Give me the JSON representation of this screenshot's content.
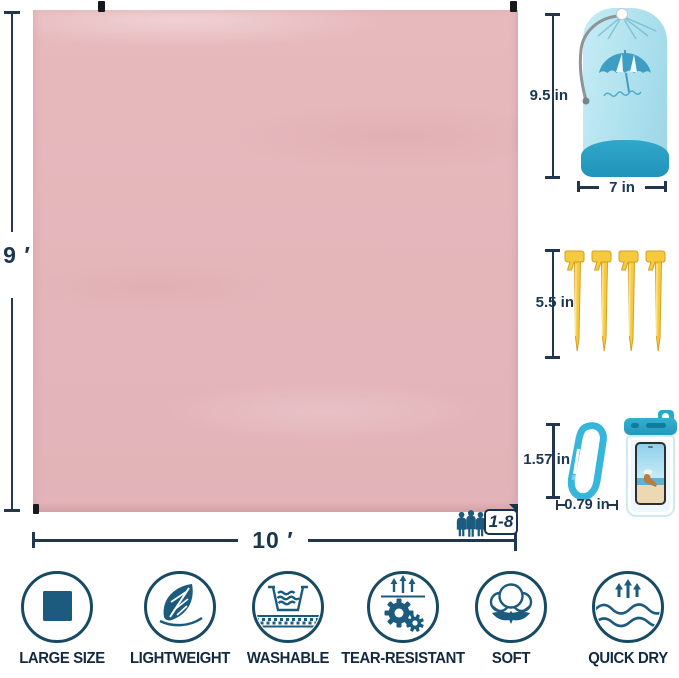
{
  "product": {
    "name": "beach-blanket-infographic",
    "blanket_color": "#e5b6bb",
    "accent_navy": "#16354d",
    "icon_blue": "#1d5b7e",
    "sack_blue": "#b9e6f0",
    "sack_band_blue": "#2aa5c9",
    "stake_yellow": "#f6ca3e",
    "carabiner_blue": "#36b6db"
  },
  "dims": {
    "blanket_height": "9 ′",
    "blanket_width": "10 ′",
    "sack_height": "9.5 in",
    "sack_width": "7 in",
    "stake_length": "5.5 in",
    "carabiner_height": "1.57 in",
    "carabiner_width": "0.79 in"
  },
  "capacity": {
    "label": "1-8"
  },
  "features": [
    {
      "label": "LARGE SIZE",
      "icon": "square-icon"
    },
    {
      "label": "LIGHTWEIGHT",
      "icon": "leaf-icon"
    },
    {
      "label": "WASHABLE",
      "icon": "wash-basin-icon"
    },
    {
      "label": "TEAR-RESISTANT",
      "icon": "gears-icon"
    },
    {
      "label": "SOFT",
      "icon": "cotton-icon"
    },
    {
      "label": "QUICK DRY",
      "icon": "waves-icon"
    }
  ]
}
